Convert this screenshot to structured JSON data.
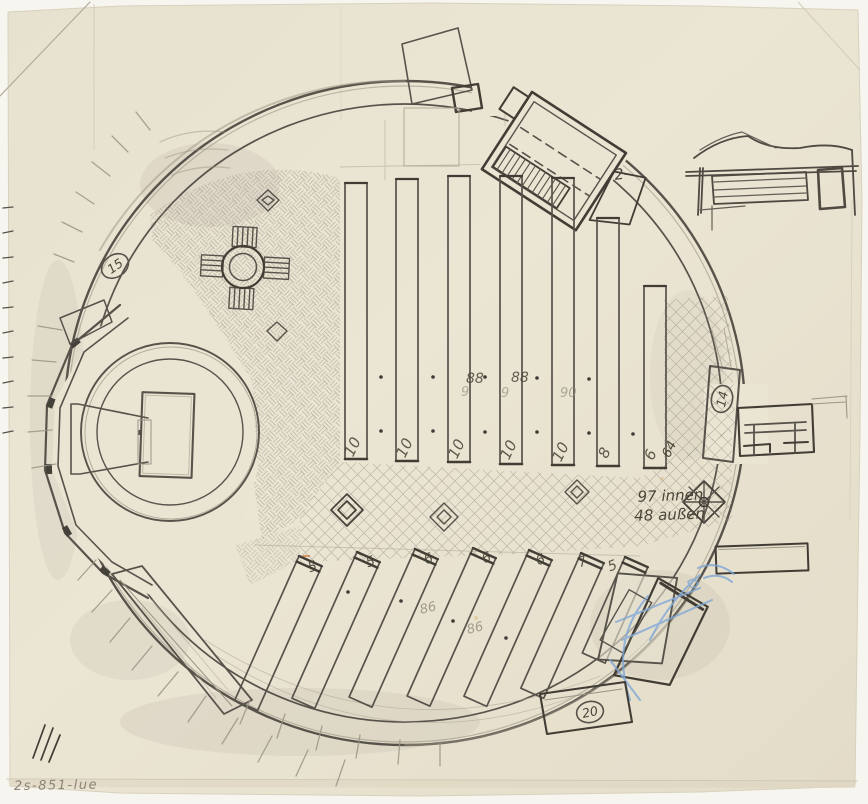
{
  "sheet": {
    "inventory_number": "2s-851-lue"
  },
  "annotations": {
    "capacity_line1": "97 innen",
    "capacity_line2": "48 außen",
    "upper_total": "64",
    "annex_label": "2-",
    "marker_left": "15",
    "marker_right": "14",
    "marker_bottom": "20"
  },
  "benches": {
    "upper_counts": [
      "10",
      "10",
      "10",
      "10",
      "10",
      "8",
      "6"
    ],
    "lower_counts": [
      "5",
      "5",
      "6",
      "6",
      "6",
      "7",
      "5"
    ],
    "aisle_dark": [
      "88",
      "88"
    ],
    "aisle_faint": [
      "9",
      "9",
      "90"
    ],
    "lower_aisle_faint": [
      "86",
      "86"
    ]
  },
  "colors": {
    "paper": "#eae4d3",
    "pencil_dark": "#413d35",
    "pencil_mid": "#6e6759",
    "pencil_light": "#9b9484",
    "blue_pencil": "#7fa7d6",
    "stain": "#d79b3f"
  }
}
